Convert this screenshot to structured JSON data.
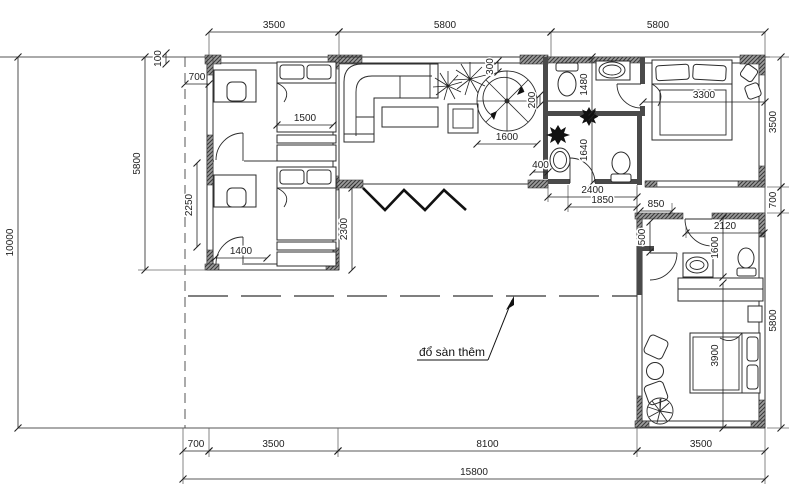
{
  "drawing": {
    "type": "floor-plan",
    "annotation": {
      "label": "đổ sàn thêm"
    },
    "colors": {
      "background": "#ffffff",
      "lines": "#2b2b2b",
      "walls": "#4a4a4a",
      "dimension_text": "#222222"
    },
    "dimensions": [
      {
        "id": "top-left-3500",
        "label": "3500",
        "orient": "h",
        "x1": 209,
        "x2": 339,
        "y": 32
      },
      {
        "id": "top-mid-5800",
        "label": "5800",
        "orient": "h",
        "x1": 339,
        "x2": 551,
        "y": 32
      },
      {
        "id": "top-right-5800",
        "label": "5800",
        "orient": "h",
        "x1": 551,
        "x2": 765,
        "y": 32
      },
      {
        "id": "right-3500",
        "label": "3500",
        "orient": "v",
        "x": 781,
        "y1": 57,
        "y2": 187
      },
      {
        "id": "right-700",
        "label": "700",
        "orient": "v",
        "x": 781,
        "y1": 187,
        "y2": 213
      },
      {
        "id": "right-5800",
        "label": "5800",
        "orient": "v",
        "x": 781,
        "y1": 213,
        "y2": 428
      },
      {
        "id": "bottom-700",
        "label": "700",
        "orient": "h",
        "x1": 183,
        "x2": 209,
        "y": 451
      },
      {
        "id": "bottom-3500-left",
        "label": "3500",
        "orient": "h",
        "x1": 209,
        "x2": 338,
        "y": 451
      },
      {
        "id": "bottom-8100",
        "label": "8100",
        "orient": "h",
        "x1": 338,
        "x2": 637,
        "y": 451
      },
      {
        "id": "bottom-3500-right",
        "label": "3500",
        "orient": "h",
        "x1": 637,
        "x2": 765,
        "y": 451
      },
      {
        "id": "bottom-15800",
        "label": "15800",
        "orient": "h",
        "x1": 183,
        "x2": 765,
        "y": 479
      },
      {
        "id": "left-10000",
        "label": "10000",
        "orient": "v",
        "x": 18,
        "y1": 57,
        "y2": 428
      },
      {
        "id": "left-5800",
        "label": "5800",
        "orient": "v",
        "x": 145,
        "y1": 57,
        "y2": 270
      },
      {
        "id": "offset-100",
        "label": "100",
        "orient": "v",
        "x": 166,
        "y1": 53,
        "y2": 64
      },
      {
        "id": "porch-700",
        "label": "700",
        "orient": "h",
        "x1": 185,
        "x2": 209,
        "y": 84
      },
      {
        "id": "bed1-1500",
        "label": "1500",
        "orient": "h",
        "x1": 277,
        "x2": 333,
        "y": 125
      },
      {
        "id": "room2-2250",
        "label": "2250",
        "orient": "v",
        "x": 197,
        "y1": 163,
        "y2": 247
      },
      {
        "id": "room2-1400",
        "label": "1400",
        "orient": "h",
        "x1": 215,
        "x2": 267,
        "y": 258
      },
      {
        "id": "wing-2300",
        "label": "2300",
        "orient": "v",
        "x": 352,
        "y1": 188,
        "y2": 270
      },
      {
        "id": "stair-1600",
        "label": "1600",
        "orient": "h",
        "x1": 477,
        "x2": 537,
        "y": 144
      },
      {
        "id": "stair-300",
        "label": "300",
        "orient": "v",
        "x": 498,
        "y1": 61,
        "y2": 72
      },
      {
        "id": "stair-200",
        "label": "200",
        "orient": "v",
        "x": 540,
        "y1": 95,
        "y2": 105
      },
      {
        "id": "bath-1480",
        "label": "1480",
        "orient": "v",
        "x": 592,
        "y1": 57,
        "y2": 112
      },
      {
        "id": "wc-1640",
        "label": "1640",
        "orient": "v",
        "x": 592,
        "y1": 117,
        "y2": 183
      },
      {
        "id": "wall-400",
        "label": "400",
        "orient": "h",
        "x1": 533,
        "x2": 548,
        "y": 172
      },
      {
        "id": "wc-2400",
        "label": "2400",
        "orient": "h",
        "x1": 548,
        "x2": 637,
        "y": 197
      },
      {
        "id": "wc-1850",
        "label": "1850",
        "orient": "h",
        "x1": 568,
        "x2": 637,
        "y": 207
      },
      {
        "id": "gap-850",
        "label": "850",
        "orient": "h",
        "x1": 640,
        "x2": 672,
        "y": 211
      },
      {
        "id": "masterbed-3300",
        "label": "3300",
        "orient": "h",
        "x1": 643,
        "x2": 765,
        "y": 102
      },
      {
        "id": "bedroom2-2120",
        "label": "2120",
        "orient": "h",
        "x1": 686,
        "x2": 764,
        "y": 233
      },
      {
        "id": "niche-500",
        "label": "500",
        "orient": "v",
        "x": 650,
        "y1": 222,
        "y2": 252
      },
      {
        "id": "wash-1600",
        "label": "1600",
        "orient": "v",
        "x": 723,
        "y1": 218,
        "y2": 277
      },
      {
        "id": "bedroom2-3900",
        "label": "3900",
        "orient": "v",
        "x": 723,
        "y1": 283,
        "y2": 428
      }
    ]
  }
}
